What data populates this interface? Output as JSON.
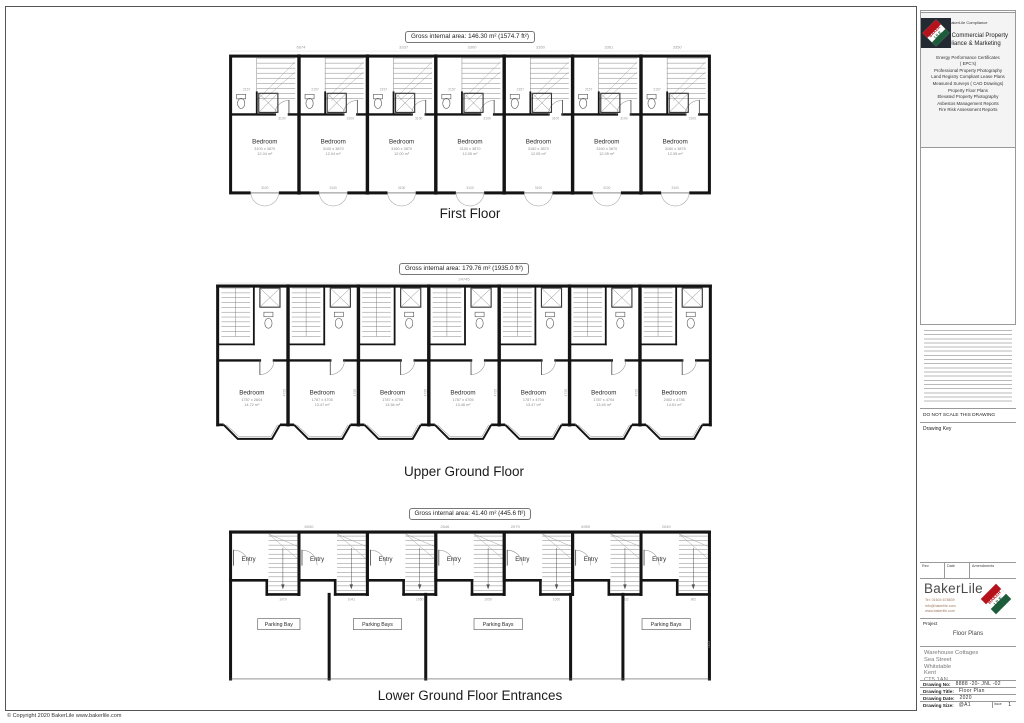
{
  "sheet": {
    "copyright": "© Copyright 2020 BakerLile   www.bakerlile.com"
  },
  "floors": [
    {
      "area_label": "Gross internal area: 146.30 m² (1574.7 ft²)",
      "title": "First Floor",
      "top_dims": [
        "6674",
        "3337",
        "3300",
        "3350",
        "3361",
        "3350"
      ],
      "inner_dims": {
        "bath": "2157",
        "wall": "3100",
        "window": "3100"
      },
      "units": [
        {
          "room": "Bedroom",
          "dims": "3100 x 3870",
          "area": "12.04 m²"
        },
        {
          "room": "Bedroom",
          "dims": "3100 x 3870",
          "area": "12.04 m²"
        },
        {
          "room": "Bedroom",
          "dims": "3160 x 3870",
          "area": "12.00 m²"
        },
        {
          "room": "Bedroom",
          "dims": "3100 x 3870",
          "area": "12.05 m²"
        },
        {
          "room": "Bedroom",
          "dims": "3160 x 3870",
          "area": "12.05 m²"
        },
        {
          "room": "Bedroom",
          "dims": "3160 x 3870",
          "area": "12.05 m²"
        },
        {
          "room": "Bedroom",
          "dims": "3160 x 3875",
          "area": "12.05 m²"
        }
      ]
    },
    {
      "area_label": "Gross internal area: 179.76 m² (1935.0 ft²)",
      "title": "Upper Ground Floor",
      "top_dims": [
        "24745"
      ],
      "side_dim": "4705",
      "units": [
        {
          "room": "Bedroom",
          "dims": "1787 x 2604",
          "area": "14.72 m²"
        },
        {
          "room": "Bedroom",
          "dims": "1787 x 4705",
          "area": "13.47 m²"
        },
        {
          "room": "Bedroom",
          "dims": "1787 x 4705",
          "area": "13.36 m²"
        },
        {
          "room": "Bedroom",
          "dims": "1787 x 4705",
          "area": "13.48 m²"
        },
        {
          "room": "Bedroom",
          "dims": "1787 x 4704",
          "area": "13.47 m²"
        },
        {
          "room": "Bedroom",
          "dims": "1787 x 4704",
          "area": "13.45 m²"
        },
        {
          "room": "Bedroom",
          "dims": "2402 x 4736",
          "area": "14.91 m²"
        }
      ]
    },
    {
      "area_label": "Gross internal area: 41.40 m² (445.6 ft²)",
      "title": "Lower Ground Floor Entrances",
      "top_dims": [
        "6930",
        "2646",
        "2079",
        "6959",
        "2049"
      ],
      "stair_dims": [
        "1079",
        "1041",
        "1050",
        "1050",
        "1050",
        "1332",
        "902"
      ],
      "side_dim": "7423",
      "units": [
        {
          "room": "Entry"
        },
        {
          "room": "Entry"
        },
        {
          "room": "Entry"
        },
        {
          "room": "Entry"
        },
        {
          "room": "Entry"
        },
        {
          "room": "Entry"
        },
        {
          "room": "Entry"
        }
      ],
      "parking_labels": [
        "Parking Bay",
        "Parking Bays",
        "Parking Bays",
        "Parking Bays"
      ]
    }
  ],
  "titleblock": {
    "compliance_caption": "BakerLile Compliance",
    "heading": "National Commercial Property Compliance & Marketing",
    "services": [
      "Energy Performance Certificates",
      "( EPC's)",
      "Professional Property Photography",
      "Land Registry Compliant Lease Plans",
      "Measured Surveys ( CAD Drawings)",
      "Property Floor Plans",
      "Elevated Property Photography",
      "Asbestos Management Reports",
      "Fire Risk Assessment Reports"
    ],
    "do_not_scale": "DO NOT SCALE THIS DRAWING",
    "drawing_key": "Drawing Key",
    "rev_header": {
      "rev": "Rev",
      "date": "Date",
      "amendments": "Amendments"
    },
    "brand": "BakerLile",
    "contact": {
      "tel": "Tel: 01604 678839",
      "email": "info@bakerlile.com",
      "web": "www.bakerlile.com"
    },
    "logo_top": "BAKER",
    "logo_bottom": "LILE",
    "project_label": "Project",
    "project_value": "Floor Plans",
    "address": [
      "Warehouse Cottages",
      "Sea Street",
      "Whitstable",
      "Kent",
      "CT5 1AN"
    ],
    "rows": {
      "no_label": "Drawing No:",
      "no": "8888 -20- JNL -02",
      "title_label": "Drawing Title:",
      "title": "Floor Plan",
      "date_label": "Drawing Date:",
      "date": "2020",
      "size_label": "Drawing Size:",
      "size": "@A1",
      "issue_label": "Issue",
      "issue": "1"
    },
    "colors": {
      "logo_red": "#b5121b",
      "logo_green": "#1c5c3a",
      "wall": "#141414",
      "dim_gray": "#9a9a9a"
    }
  }
}
